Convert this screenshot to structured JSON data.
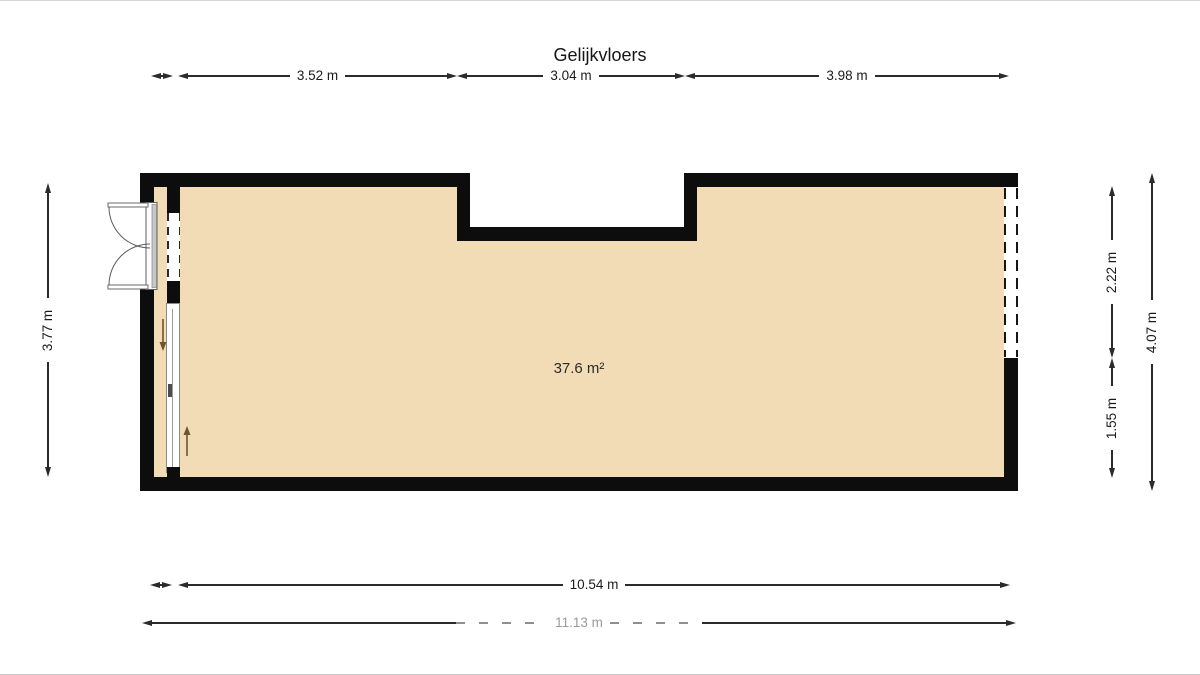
{
  "title": "Gelijkvloers",
  "room": {
    "area_label": "37.6 m²"
  },
  "dimensions": {
    "top": {
      "left": "3.52 m",
      "middle": "3.04 m",
      "right": "3.98 m"
    },
    "left_side": {
      "total": "3.77 m"
    },
    "right_side": {
      "upper": "2.22 m",
      "lower": "1.55 m",
      "total": "4.07 m"
    },
    "bottom": {
      "inner": "10.54 m",
      "outer": "11.13 m"
    }
  },
  "colors": {
    "floor": "#f1dcb5",
    "wall": "#0d0d0d",
    "dim_line": "#2b2b2b",
    "faded_dim": "#9a9a9a",
    "slide_arrow": "#6b5630"
  }
}
